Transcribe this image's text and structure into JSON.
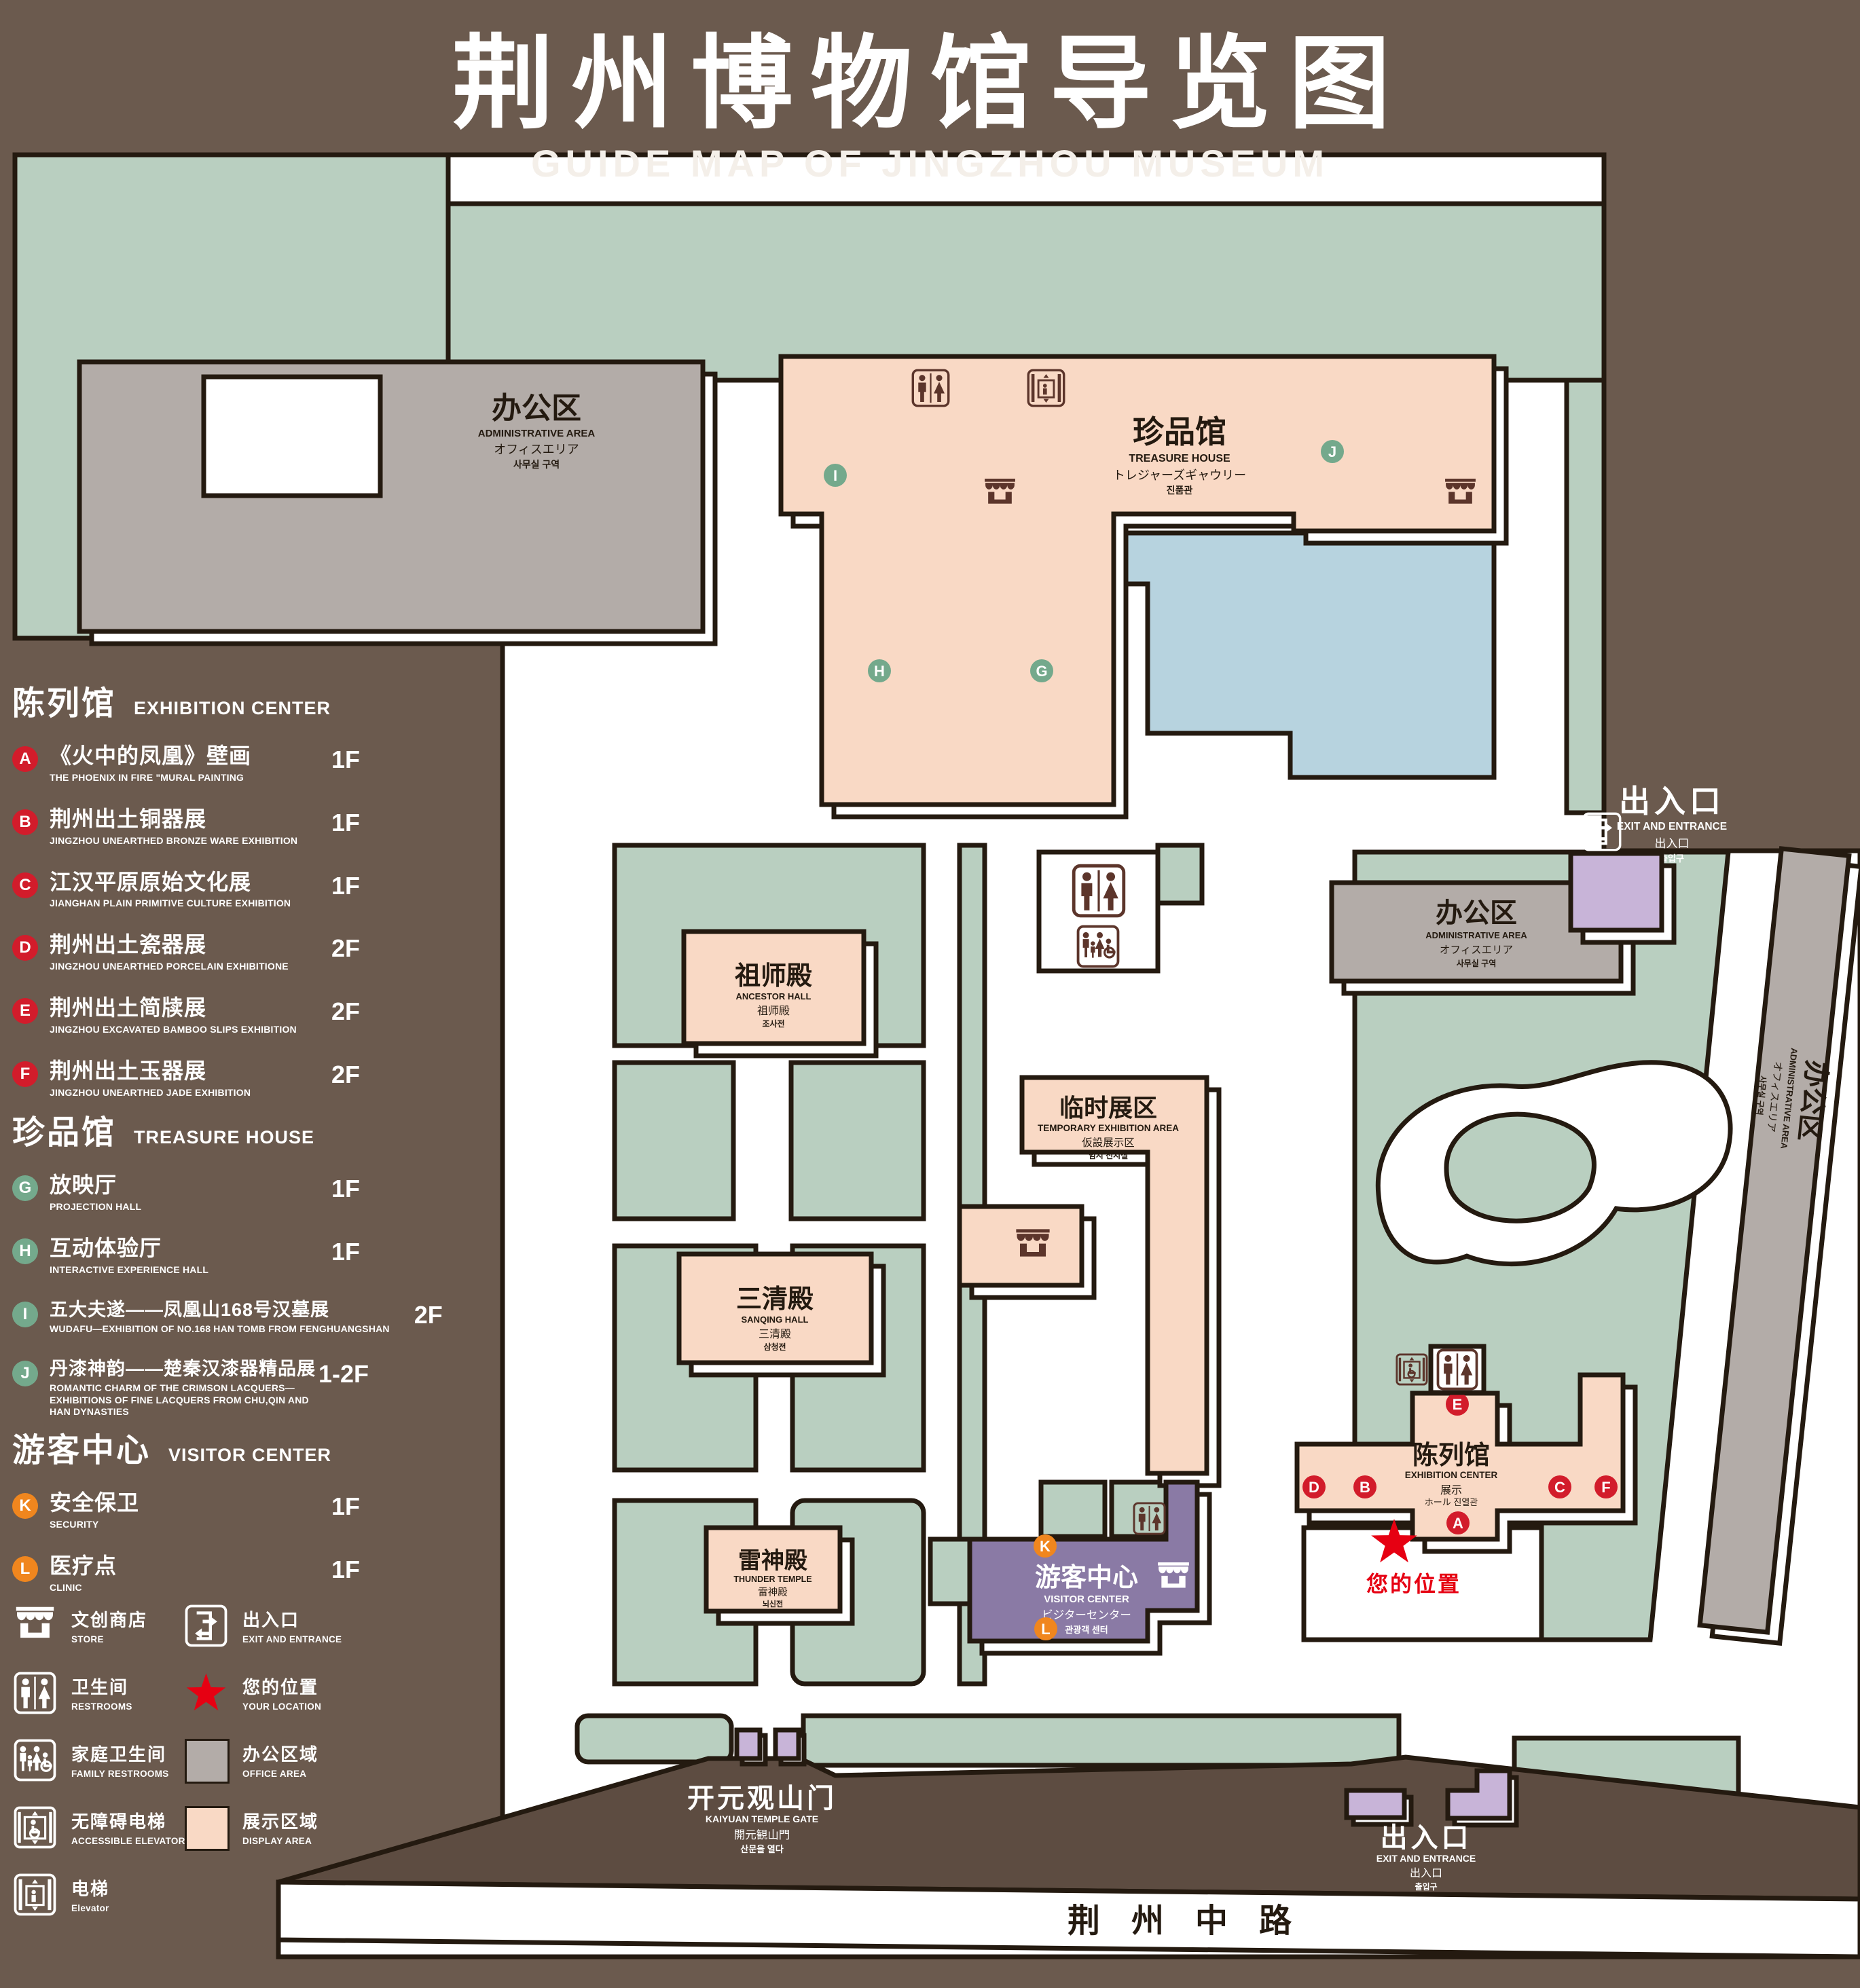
{
  "title": {
    "zh": "荆州博物馆导览图",
    "en": "GUIDE MAP OF JINGZHOU MUSEUM"
  },
  "colors": {
    "background": "#6b5a4e",
    "lawn": "#b9cfc0",
    "display_area": "#f9d9c5",
    "office_area": "#b3aca8",
    "visitor_center_purple": "#8a7aa5",
    "gate_purple": "#c8b4d8",
    "pond_blue": "#b7d3df",
    "outline": "#241a10",
    "marker_red": "#d21c2b",
    "marker_green": "#74a98c",
    "marker_orange": "#f0861e",
    "location_red": "#e60012",
    "map_icon_brown": "#5c352b"
  },
  "legend": {
    "sections": [
      {
        "zh": "陈列馆",
        "en": "EXHIBITION CENTER",
        "marker_color": "#d21c2b",
        "items": [
          {
            "letter": "A",
            "zh": "《火中的凤凰》壁画",
            "en": "THE PHOENIX IN FIRE \"MURAL PAINTING",
            "floor": "1F"
          },
          {
            "letter": "B",
            "zh": "荆州出土铜器展",
            "en": "JINGZHOU UNEARTHED BRONZE WARE EXHIBITION",
            "floor": "1F"
          },
          {
            "letter": "C",
            "zh": "江汉平原原始文化展",
            "en": "JIANGHAN PLAIN PRIMITIVE CULTURE EXHIBITION",
            "floor": "1F"
          },
          {
            "letter": "D",
            "zh": "荆州出土瓷器展",
            "en": "JINGZHOU UNEARTHED PORCELAIN EXHIBITIONE",
            "floor": "2F"
          },
          {
            "letter": "E",
            "zh": "荆州出土简牍展",
            "en": "JINGZHOU EXCAVATED BAMBOO SLIPS EXHIBITION",
            "floor": "2F"
          },
          {
            "letter": "F",
            "zh": "荆州出土玉器展",
            "en": "JINGZHOU UNEARTHED JADE EXHIBITION",
            "floor": "2F"
          }
        ]
      },
      {
        "zh": "珍品馆",
        "en": "TREASURE HOUSE",
        "marker_color": "#74a98c",
        "items": [
          {
            "letter": "G",
            "zh": "放映厅",
            "en": "PROJECTION HALL",
            "floor": "1F"
          },
          {
            "letter": "H",
            "zh": "互动体验厅",
            "en": "INTERACTIVE EXPERIENCE HALL",
            "floor": "1F"
          },
          {
            "letter": "I",
            "zh": "五大夫遂——凤凰山168号汉墓展",
            "en": "WUDAFU—EXHIBITION OF NO.168 HAN TOMB FROM FENGHUANGSHAN",
            "floor": "2F"
          },
          {
            "letter": "J",
            "zh": "丹漆神韵——楚秦汉漆器精品展",
            "en": "ROMANTIC CHARM OF THE CRIMSON LACQUERS—EXHIBITIONS OF FINE LACQUERS FROM CHU,QIN AND HAN DYNASTIES",
            "floor": "1-2F"
          }
        ]
      },
      {
        "zh": "游客中心",
        "en": "VISITOR CENTER",
        "marker_color": "#f0861e",
        "items": [
          {
            "letter": "K",
            "zh": "安全保卫",
            "en": "SECURITY",
            "floor": "1F"
          },
          {
            "letter": "L",
            "zh": "医疗点",
            "en": "CLINIC",
            "floor": "1F"
          }
        ]
      }
    ],
    "icons": [
      {
        "name": "store-icon",
        "zh": "文创商店",
        "en": "STORE"
      },
      {
        "name": "restrooms-icon",
        "zh": "卫生间",
        "en": "RESTROOMS"
      },
      {
        "name": "family-restrooms-icon",
        "zh": "家庭卫生间",
        "en": "FAMILY RESTROOMS"
      },
      {
        "name": "accessible-elevator-icon",
        "zh": "无障碍电梯",
        "en": "ACCESSIBLE ELEVATOR"
      },
      {
        "name": "elevator-icon",
        "zh": "电梯",
        "en": "Elevator"
      },
      {
        "name": "exit-entrance-icon",
        "zh": "出入口",
        "en": "EXIT AND ENTRANCE"
      },
      {
        "name": "your-location-icon",
        "zh": "您的位置",
        "en": "YOUR LOCATION"
      },
      {
        "name": "office-area-swatch",
        "zh": "办公区域",
        "en": "OFFICE AREA"
      },
      {
        "name": "display-area-swatch",
        "zh": "展示区域",
        "en": "DISPLAY AREA"
      }
    ]
  },
  "map": {
    "letters": {
      "a": "A",
      "b": "B",
      "c": "C",
      "d": "D",
      "e": "E",
      "f": "F",
      "g": "G",
      "h": "H",
      "i": "I",
      "j": "J",
      "k": "K",
      "l": "L"
    },
    "buildings": {
      "admin": {
        "zh": "办公区",
        "en": "ADMINISTRATIVE AREA",
        "jp": "オフィスエリア",
        "kr": "사무실 구역"
      },
      "treasure_house": {
        "zh": "珍品馆",
        "en": "TREASURE HOUSE",
        "jp": "トレジャーズギャウリー",
        "kr": "진품관"
      },
      "ancestor_hall": {
        "zh": "祖师殿",
        "en": "ANCESTOR HALL",
        "jp": "祖师殿",
        "kr": "조사전"
      },
      "temp_exhibition": {
        "zh": "临时展区",
        "en": "TEMPORARY EXHIBITION AREA",
        "jp": "仮設展示区",
        "kr": "임시 전시실"
      },
      "sanqing_hall": {
        "zh": "三清殿",
        "en": "SANQING HALL",
        "jp": "三清殿",
        "kr": "삼청전"
      },
      "thunder_temple": {
        "zh": "雷神殿",
        "en": "THUNDER TEMPLE",
        "jp": "雷神殿",
        "kr": "뇌신전"
      },
      "visitor_center": {
        "zh": "游客中心",
        "en": "VISITOR CENTER",
        "jp": "ビジターセンター",
        "kr": "관광객 센터"
      },
      "exhibition_center": {
        "zh": "陈列馆",
        "en": "EXHIBITION CENTER",
        "l3": "展示",
        "l4": "ホール 진열관"
      },
      "gate": {
        "zh": "开元观山门",
        "en": "KAIYUAN TEMPLE GATE",
        "jp": "開元観山門",
        "kr": "산문을 열다"
      },
      "exit": {
        "zh": "出入口",
        "en": "EXIT AND ENTRANCE",
        "jp": "出入口",
        "kr": "출입구"
      },
      "road": {
        "zh": "荆州中路"
      },
      "your_location": {
        "zh": "您的位置"
      }
    }
  }
}
